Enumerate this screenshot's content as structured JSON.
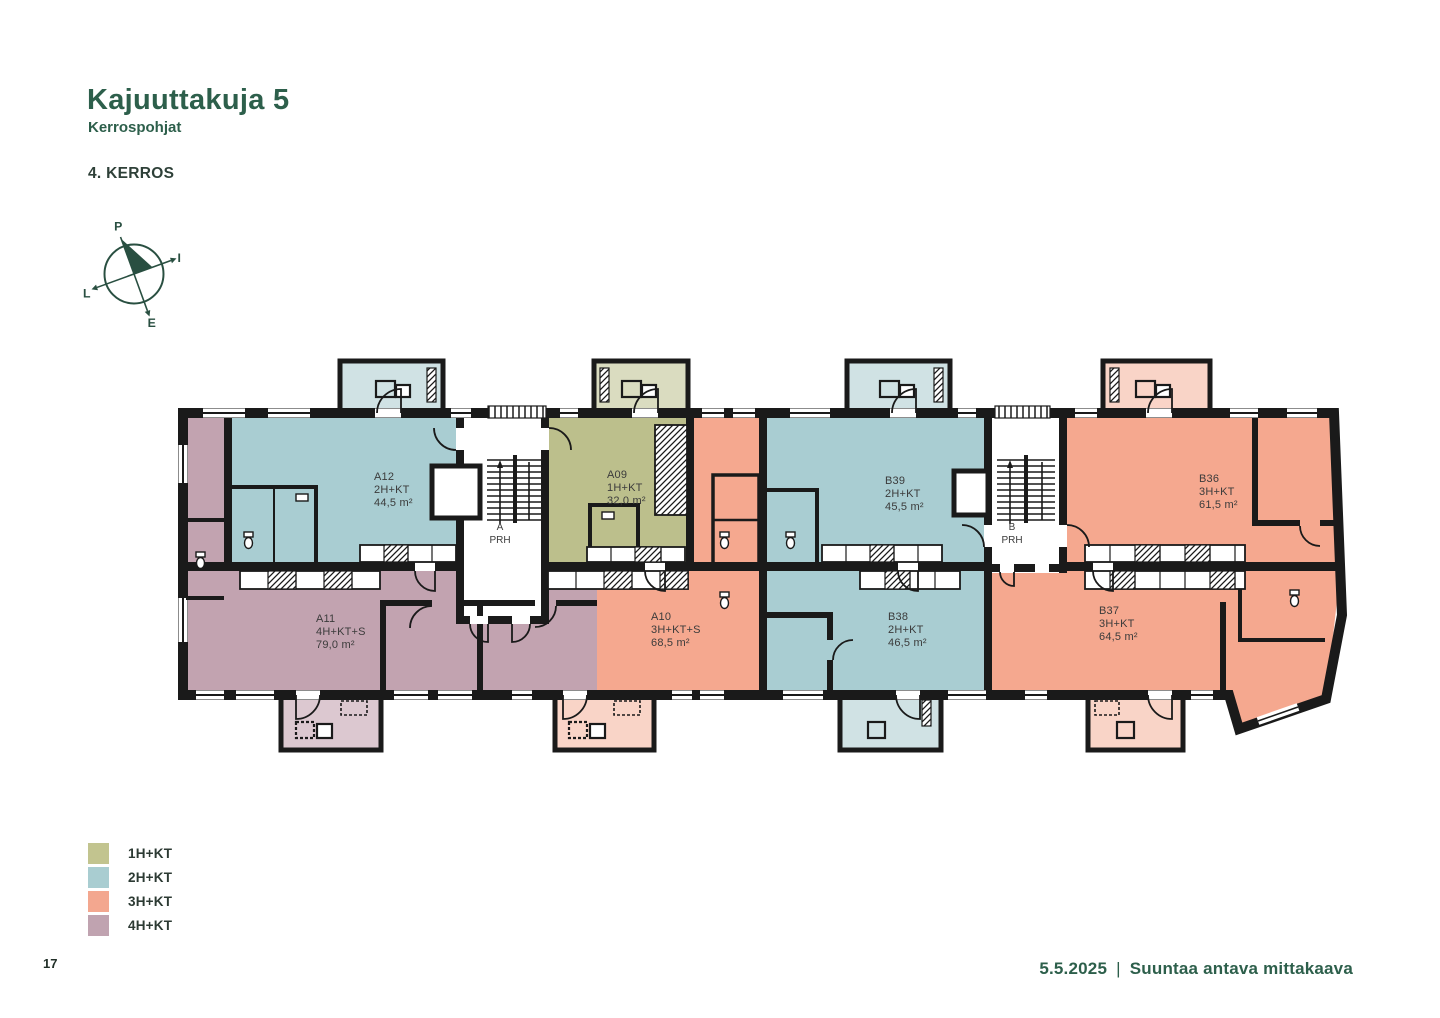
{
  "header": {
    "title": "Kajuuttakuja 5",
    "subtitle": "Kerrospohjat",
    "floor_label": "4. KERROS"
  },
  "compass": {
    "north": "P",
    "east": "I",
    "south": "E",
    "west": "L"
  },
  "plan": {
    "units": [
      {
        "code": "A12",
        "type": "2H+KT",
        "area": "44,5 m²",
        "category": "2H+KT"
      },
      {
        "code": "A09",
        "type": "1H+KT",
        "area": "32,0 m²",
        "category": "1H+KT"
      },
      {
        "code": "B39",
        "type": "2H+KT",
        "area": "45,5 m²",
        "category": "2H+KT"
      },
      {
        "code": "B36",
        "type": "3H+KT",
        "area": "61,5 m²",
        "category": "3H+KT"
      },
      {
        "code": "A11",
        "type": "4H+KT+S",
        "area": "79,0 m²",
        "category": "4H+KT"
      },
      {
        "code": "A10",
        "type": "3H+KT+S",
        "area": "68,5 m²",
        "category": "3H+KT"
      },
      {
        "code": "B38",
        "type": "2H+KT",
        "area": "46,5 m²",
        "category": "2H+KT"
      },
      {
        "code": "B37",
        "type": "3H+KT",
        "area": "64,5 m²",
        "category": "3H+KT"
      }
    ],
    "stairwells": [
      {
        "line1": "A",
        "line2": "PRH"
      },
      {
        "line1": "B",
        "line2": "PRH"
      }
    ]
  },
  "legend": {
    "items": [
      {
        "label": "1H+KT",
        "color": "#c2c48f"
      },
      {
        "label": "2H+KT",
        "color": "#a9cdd1"
      },
      {
        "label": "3H+KT",
        "color": "#f3a78f"
      },
      {
        "label": "4H+KT",
        "color": "#c0a3b0"
      }
    ]
  },
  "colors": {
    "accent": "#2d5f4b",
    "wall": "#1a1a1a",
    "apt_1h": "#bcbf8c",
    "apt_2h": "#a9cdd2",
    "apt_3h": "#f5a88f",
    "apt_4h": "#c2a3b0",
    "balc_1h": "#dadcc0",
    "balc_2h": "#d0e2e4",
    "balc_3h": "#f9d4c7",
    "balc_4h": "#dcc8d0"
  },
  "footer": {
    "page_number": "17",
    "date": "5.5.2025",
    "separator": "|",
    "note": "Suuntaa antava mittakaava"
  }
}
